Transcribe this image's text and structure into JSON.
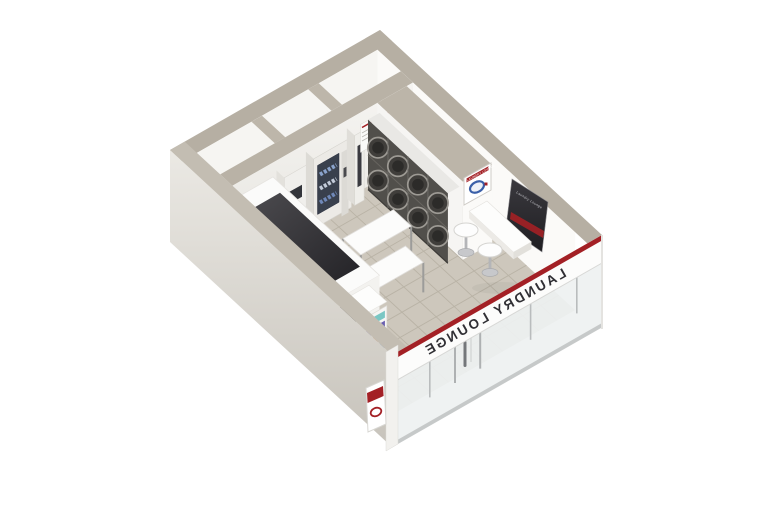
{
  "scene": {
    "type": "3d-isometric-floor-plan-render",
    "subject": "self-service laundry shop cutaway model on white background"
  },
  "brand": {
    "name": "LAUNDRY LOUNGE",
    "accent_red": "#a32025",
    "logo_blue": "#3a5fa8"
  },
  "storefront": {
    "fascia_text": "LAUNDRY LOUNGE",
    "mirrored": true
  },
  "signs": {
    "partition_sign": "LAUNDRY LOUNGE",
    "nook_poster": "Laundry Lounge"
  },
  "equipment": {
    "washer_stack_columns": 4,
    "washer_stack_rows": 2,
    "labels": {
      "washers": "stacked-washer-dryers",
      "vending": "detergent-vending-machine",
      "change": "change-machine",
      "kiosk": "payment-kiosk",
      "tables": "folding-tables",
      "stools": "round-stools",
      "counter": "wall-counter-bar",
      "shelf": "retail-detergent-shelf",
      "left_counter": "folding-counter-with-dark-top"
    }
  },
  "palette": {
    "wall_cap": "#b6afa3",
    "wall_white": "#f8f7f5",
    "floor_tile": "#cdc7bc",
    "grout": "#b7b0a3",
    "machine_dark": "#514f4b",
    "glass": "#eef1f1"
  }
}
